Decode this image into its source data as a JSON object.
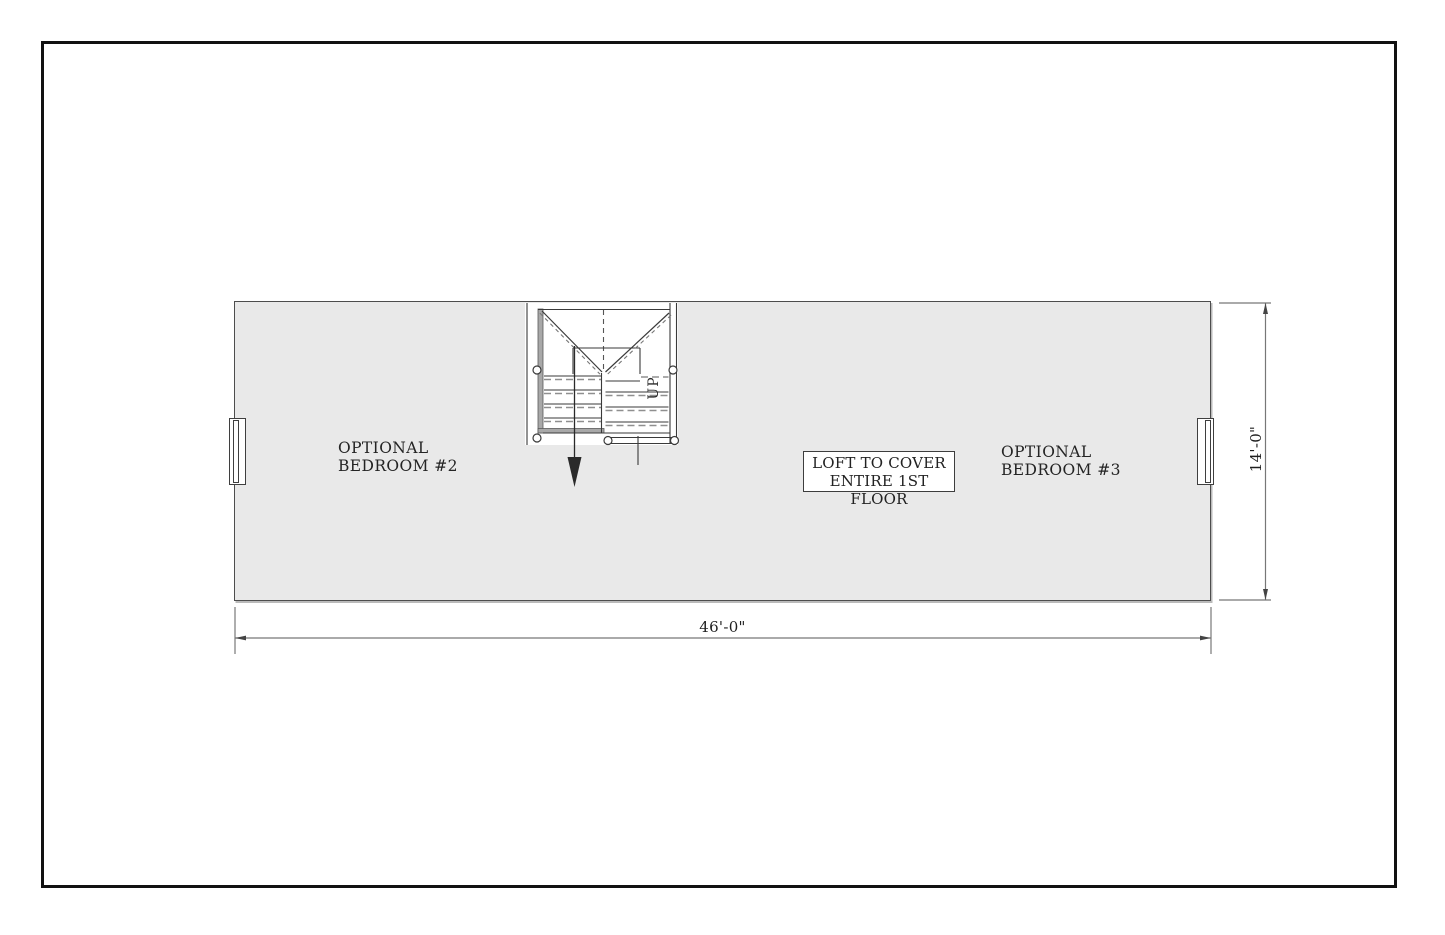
{
  "plan": {
    "bedroom2_label": {
      "line1": "OPTIONAL",
      "line2": "BEDROOM #2"
    },
    "bedroom3_label": {
      "line1": "OPTIONAL",
      "line2": "BEDROOM #3"
    },
    "loft_note": {
      "line1": "LOFT TO COVER",
      "line2": "ENTIRE 1ST FLOOR"
    },
    "stair_up_label": "UP",
    "width_dimension": "46'-0\"",
    "height_dimension": "14'-0\"",
    "colors": {
      "floor_fill": "#e9e9e9",
      "line": "#3a3a3a",
      "wall_gray": "#a8a8a8",
      "dim_line": "#777777",
      "frame": "#111111"
    }
  }
}
